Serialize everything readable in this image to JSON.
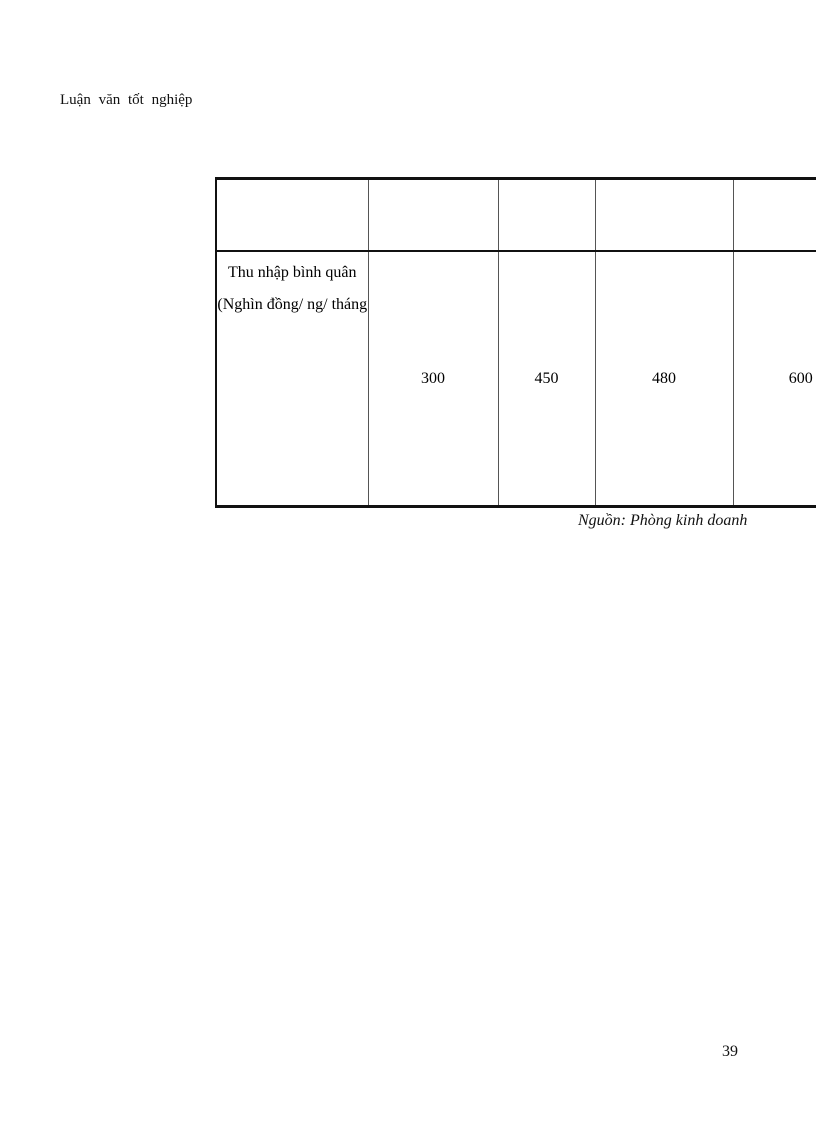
{
  "page": {
    "header": "Luận văn tốt nghiệp",
    "page_number": "39"
  },
  "table": {
    "row_label_line1": "Thu nhập bình quân",
    "row_label_line2": "(Nghìn đồng/ ng/ tháng",
    "values": [
      "300",
      "450",
      "480",
      "600"
    ]
  },
  "source": "Nguồn: Phòng kinh doanh",
  "chart_data": {
    "type": "table",
    "title": "",
    "row_label": "Thu nhập bình quân (Nghìn đồng/ ng/ tháng",
    "categories": [
      "",
      "",
      "",
      ""
    ],
    "values": [
      300,
      450,
      480,
      600
    ],
    "source": "Nguồn: Phòng kinh doanh"
  }
}
